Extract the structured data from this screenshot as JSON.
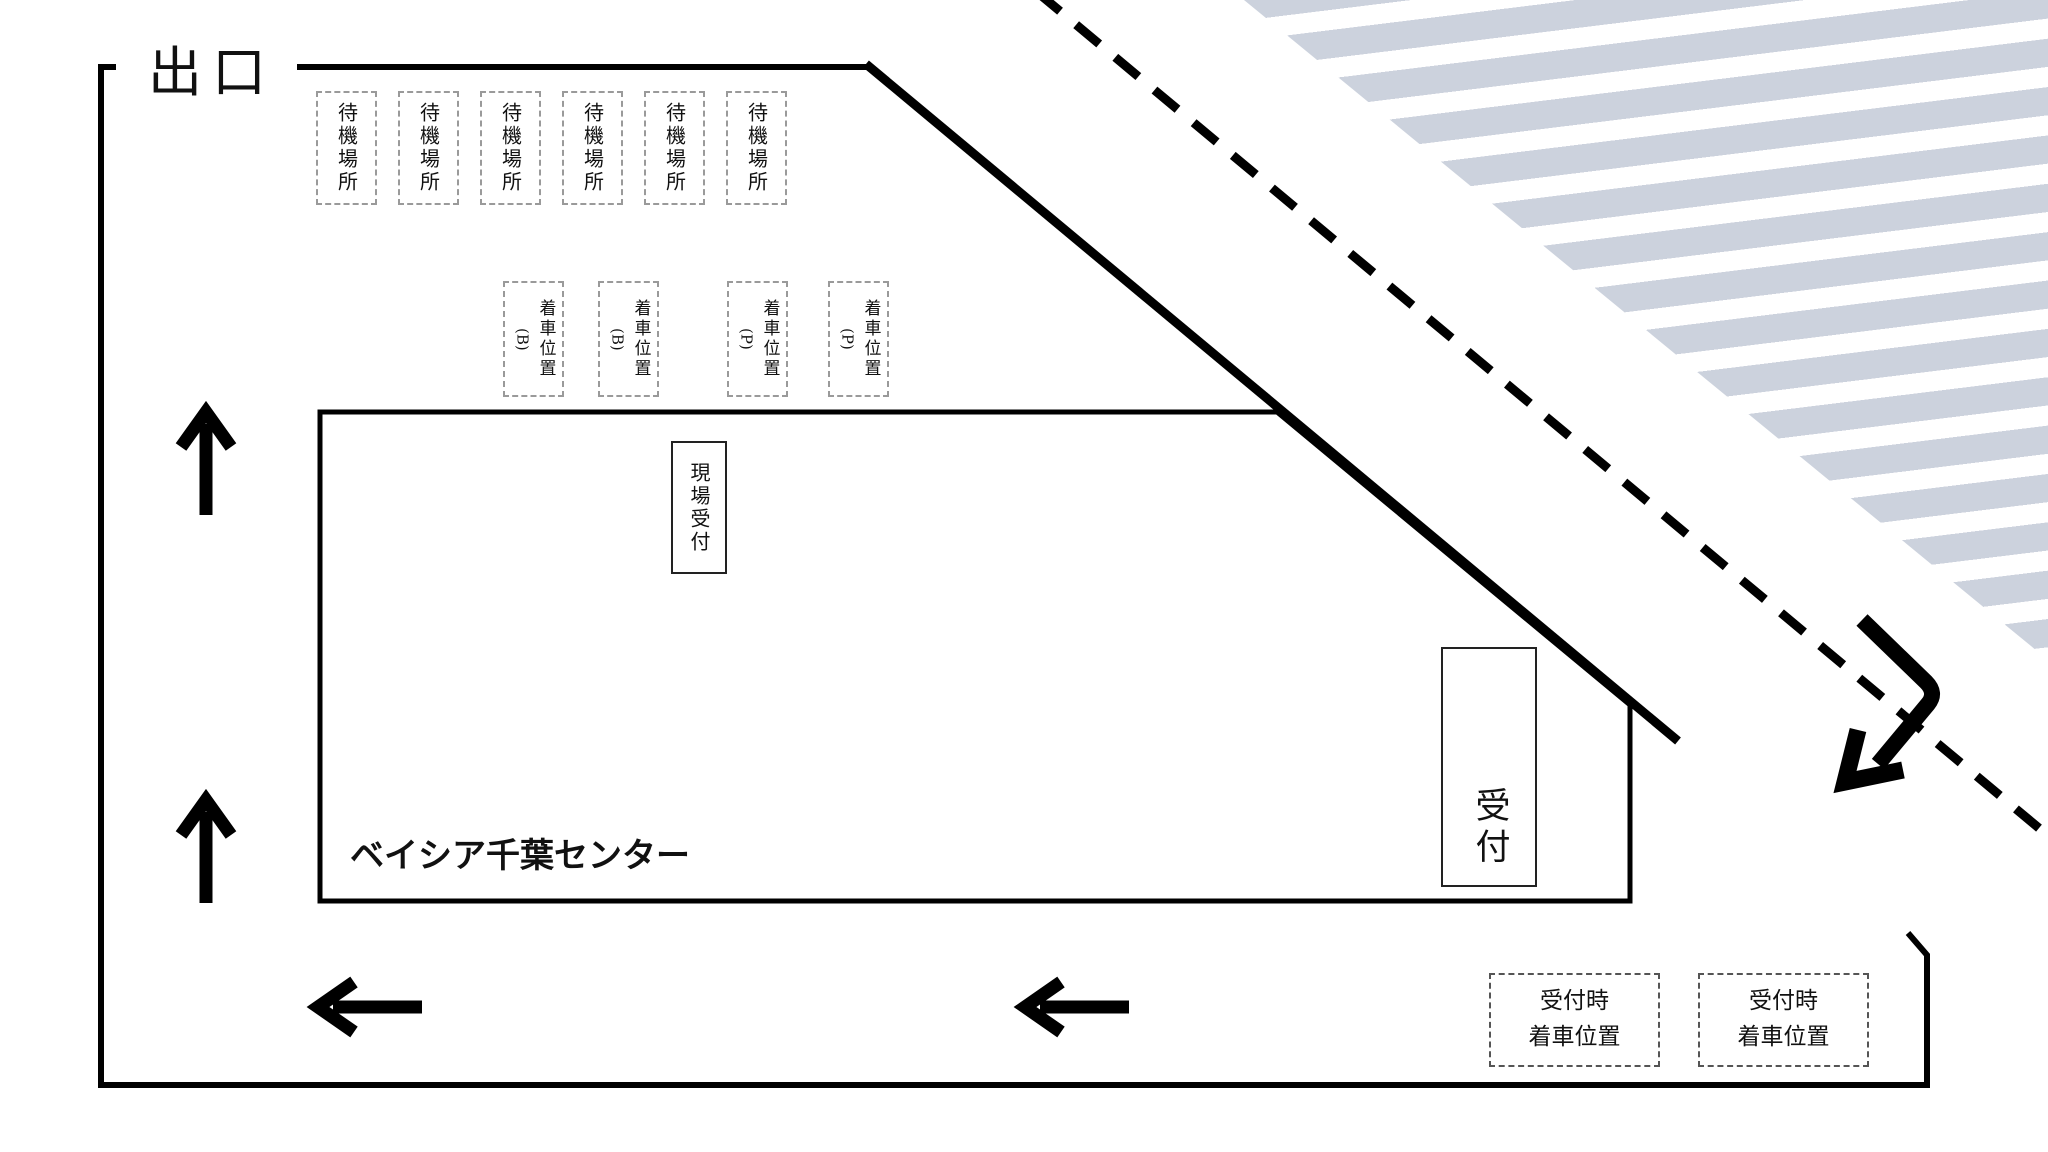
{
  "diagram": {
    "exit_label": "出口",
    "building_label": "ベイシア千葉センター",
    "reception_label": "受付",
    "field_reception_label": "現場受付",
    "waiting_area": {
      "items": [
        {
          "label": "待機場所"
        },
        {
          "label": "待機場所"
        },
        {
          "label": "待機場所"
        },
        {
          "label": "待機場所"
        },
        {
          "label": "待機場所"
        },
        {
          "label": "待機場所"
        }
      ]
    },
    "arrival_positions": {
      "items": [
        {
          "label": "着車位置",
          "code": "(B)"
        },
        {
          "label": "着車位置",
          "code": "(B)"
        },
        {
          "label": "着車位置",
          "code": "(P)"
        },
        {
          "label": "着車位置",
          "code": "(P)"
        }
      ]
    },
    "reception_arrival": {
      "items": [
        {
          "line1": "受付時",
          "line2": "着車位置"
        },
        {
          "line1": "受付時",
          "line2": "着車位置"
        }
      ]
    },
    "icons": {
      "up_arrow": "↑",
      "left_arrow": "←",
      "u_turn_arrow": "⤵"
    },
    "colors": {
      "line": "#000000",
      "hatch_stripe": "#ccd2dd"
    }
  }
}
